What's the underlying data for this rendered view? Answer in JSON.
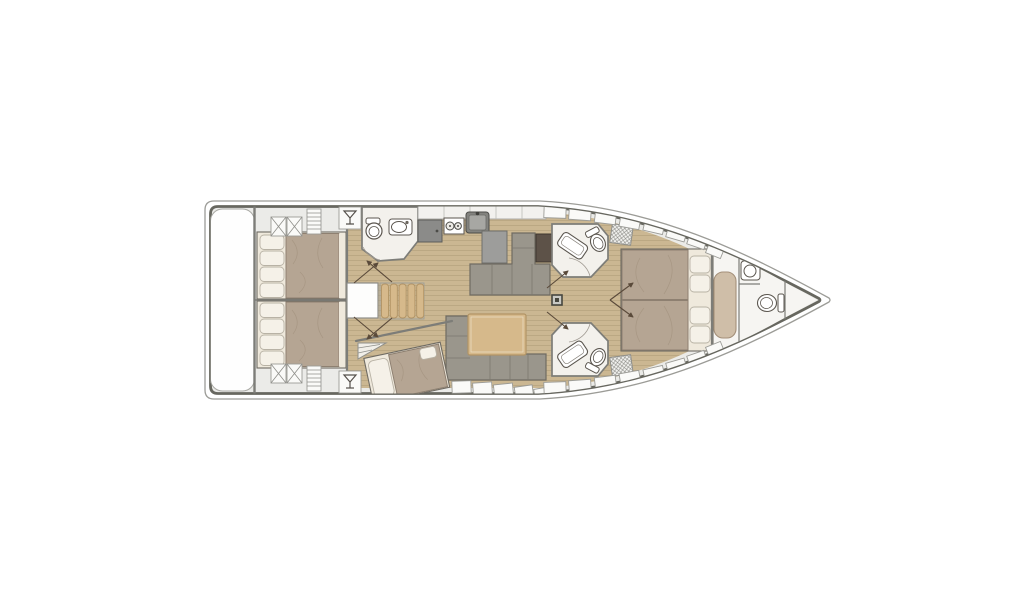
{
  "diagram": {
    "type": "yacht-interior-floor-plan",
    "orientation": "bow-facing-right",
    "regions": [
      "swim-platform",
      "aft-cabin-port",
      "aft-cabin-starboard",
      "aft-head",
      "wet-bar",
      "companionway-stairs",
      "galley",
      "navigation-station",
      "saloon",
      "single-berth-cabin",
      "mid-head-port",
      "mid-head-starboard",
      "owner-cabin",
      "bow-head",
      "anchor-locker"
    ],
    "icons": [
      "martini-glass-icon",
      "toilet-icon",
      "sink-icon",
      "shower-icon",
      "stove-icon",
      "fridge-icon",
      "mast-base-icon",
      "stairs-icon",
      "door-swing-icon",
      "x-locker-icon",
      "louver-locker-icon"
    ]
  },
  "theme": {
    "bg": "#ffffff",
    "hull_outer": "#9c9c97",
    "hull_stroke": "#67675f",
    "deck": "#ebebe8",
    "floor_wood": "#cbb792",
    "plank_line": "#b7a57f",
    "mattress": "#b5a593",
    "mattress_edge": "#8e8071",
    "pillow": "#f5f1e8",
    "pillow_edge": "#b8b2a5",
    "sheet": "#efe9dc",
    "sofa": "#9a968c",
    "sofa_edge": "#6f6b62",
    "wood_furniture": "#d6b98b",
    "wood_edge": "#b29465",
    "counter": "#9d9d9b",
    "counter_edge": "#6f6f6b",
    "fridge": "#8b8b89",
    "desk": "#5d5248",
    "bath_floor": "#f3f1ec",
    "fixture_edge": "#5b564f",
    "wall": "#7d7d78",
    "door": "#5a4a3a",
    "bench": "#cfbea8",
    "bench_edge": "#a4907a",
    "bow_floor": "#f6f5f2"
  }
}
